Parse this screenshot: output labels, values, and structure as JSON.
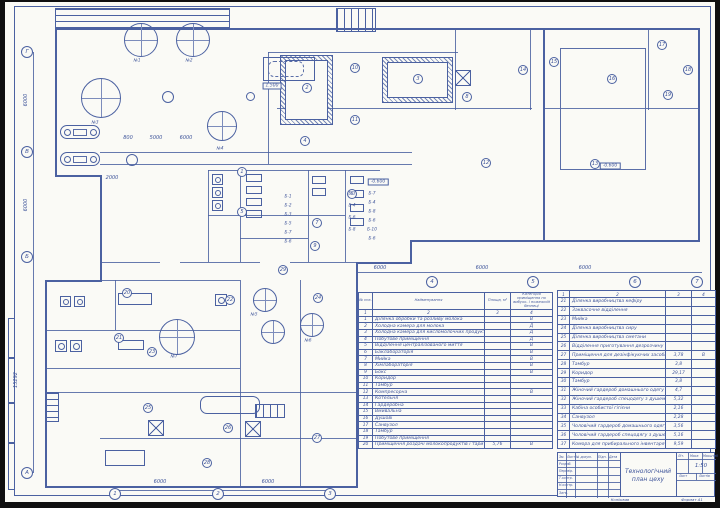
{
  "colors": {
    "line": "#4b61a1",
    "text": "#3e549a",
    "sheet": "#fafaf6",
    "background": "#121212"
  },
  "stamp": {
    "title_line1": "Технологічний",
    "title_line2": "план цеху",
    "scale_value": "1:50",
    "header_cols": [
      "Зм.",
      "Лист",
      "№ докум.",
      "Підп.",
      "Дата"
    ],
    "role_rows": [
      "Розроб.",
      "Перевір.",
      "Т.контр.",
      "Н.контр.",
      "Затв."
    ],
    "lit_label": "Літ.",
    "mass_label": "Маса",
    "scale_label": "Масштаб",
    "sheet_label": "Лист",
    "sheets_label": "Листів",
    "copied_label": "Копіював",
    "format_label": "Формат А1"
  },
  "room_table_1": {
    "headers": [
      "№ поз.",
      "Найменування",
      "Площа, м²",
      "Категорія приміщення по вибухо- і пожежній безпеці"
    ],
    "col_numbers": [
      "1",
      "2",
      "3",
      "4"
    ],
    "rows": [
      [
        "1",
        "Ділянка обробки та розливу молока",
        "",
        "В"
      ],
      [
        "2",
        "Холодна камера для молока",
        "",
        "Д"
      ],
      [
        "3",
        "Холодна камера для кисломолочних продуктів",
        "",
        "Д"
      ],
      [
        "4",
        "Побутове приміщення",
        "",
        "Д"
      ],
      [
        "5",
        "Відділення централізованого миття",
        "",
        "В"
      ],
      [
        "6",
        "Баклабораторія",
        "",
        "В"
      ],
      [
        "7",
        "Мийка",
        "",
        "В"
      ],
      [
        "8",
        "Хімлабораторія",
        "",
        "В"
      ],
      [
        "9",
        "Бокс",
        "",
        "В"
      ],
      [
        "10",
        "Коридор",
        "",
        ""
      ],
      [
        "11",
        "Тамбур",
        "",
        ""
      ],
      [
        "12",
        "Компресорна",
        "",
        "В"
      ],
      [
        "13",
        "Котельня",
        "",
        ""
      ],
      [
        "14",
        "Гардеробна",
        "",
        ""
      ],
      [
        "15",
        "Вмивальна",
        "",
        ""
      ],
      [
        "16",
        "Душові",
        "",
        ""
      ],
      [
        "17",
        "Санвузол",
        "",
        ""
      ],
      [
        "18",
        "Тамбур",
        "",
        ""
      ],
      [
        "19",
        "Побутове приміщення",
        "",
        ""
      ],
      [
        "20",
        "Приміщення роздачі молокопродуктів і тари",
        "5,76",
        "В"
      ]
    ]
  },
  "room_table_2": {
    "col_numbers": [
      "1",
      "2",
      "3",
      "4"
    ],
    "rows": [
      [
        "21",
        "Ділянка виробництва кефіру",
        "",
        ""
      ],
      [
        "22",
        "Заквасочне відділення",
        "",
        ""
      ],
      [
        "23",
        "Мийка",
        "",
        ""
      ],
      [
        "24",
        "Ділянка виробництва сиру",
        "",
        ""
      ],
      [
        "25",
        "Ділянка виробництва сметани",
        "",
        ""
      ],
      [
        "26",
        "Відділення приготування дезрозчину",
        "",
        ""
      ],
      [
        "27",
        "Приміщення для дезінфікуючих засобів",
        "3,78",
        "В"
      ],
      [
        "28",
        "Тамбур",
        "3,8",
        ""
      ],
      [
        "29",
        "Коридор",
        "29,17",
        ""
      ],
      [
        "30",
        "Тамбур",
        "3,8",
        ""
      ],
      [
        "31",
        "Жіночий гардероб домашнього одягу",
        "4,7",
        ""
      ],
      [
        "32",
        "Жіночий гардероб спецодягу з душем",
        "5,32",
        ""
      ],
      [
        "33",
        "Кабіна особистої гігієни",
        "2,16",
        ""
      ],
      [
        "34",
        "Санвузол",
        "2,28",
        ""
      ],
      [
        "35",
        "Чоловічий гардероб домашнього одягу",
        "3,56",
        ""
      ],
      [
        "36",
        "Чоловічий гардероб спецодягу з душем",
        "5,16",
        ""
      ],
      [
        "37",
        "Комора для прибирального інвентаря",
        "9,59",
        ""
      ]
    ]
  },
  "plan": {
    "room_markers": [
      {
        "n": "1",
        "x": 242,
        "y": 172
      },
      {
        "n": "2",
        "x": 307,
        "y": 88
      },
      {
        "n": "3",
        "x": 418,
        "y": 79
      },
      {
        "n": "4",
        "x": 305,
        "y": 141
      },
      {
        "n": "5",
        "x": 242,
        "y": 212
      },
      {
        "n": "6",
        "x": 352,
        "y": 194
      },
      {
        "n": "7",
        "x": 317,
        "y": 223
      },
      {
        "n": "8",
        "x": 467,
        "y": 97
      },
      {
        "n": "9",
        "x": 315,
        "y": 246
      },
      {
        "n": "10",
        "x": 355,
        "y": 68
      },
      {
        "n": "11",
        "x": 355,
        "y": 120
      },
      {
        "n": "12",
        "x": 486,
        "y": 163
      },
      {
        "n": "13",
        "x": 595,
        "y": 164
      },
      {
        "n": "14",
        "x": 523,
        "y": 70
      },
      {
        "n": "15",
        "x": 554,
        "y": 62
      },
      {
        "n": "16",
        "x": 612,
        "y": 79
      },
      {
        "n": "17",
        "x": 662,
        "y": 45
      },
      {
        "n": "18",
        "x": 688,
        "y": 70
      },
      {
        "n": "19",
        "x": 668,
        "y": 95
      },
      {
        "n": "20",
        "x": 127,
        "y": 293
      },
      {
        "n": "21",
        "x": 119,
        "y": 338
      },
      {
        "n": "22",
        "x": 230,
        "y": 300
      },
      {
        "n": "23",
        "x": 152,
        "y": 352
      },
      {
        "n": "24",
        "x": 318,
        "y": 298
      },
      {
        "n": "25",
        "x": 148,
        "y": 408
      },
      {
        "n": "26",
        "x": 228,
        "y": 428
      },
      {
        "n": "27",
        "x": 317,
        "y": 438
      },
      {
        "n": "28",
        "x": 207,
        "y": 463
      },
      {
        "n": "29",
        "x": 283,
        "y": 270
      }
    ],
    "grid_markers": [
      {
        "n": "1",
        "x": 115,
        "y": 494
      },
      {
        "n": "2",
        "x": 218,
        "y": 494
      },
      {
        "n": "3",
        "x": 330,
        "y": 494
      },
      {
        "n": "4",
        "x": 432,
        "y": 282
      },
      {
        "n": "5",
        "x": 533,
        "y": 282
      },
      {
        "n": "6",
        "x": 635,
        "y": 282
      },
      {
        "n": "7",
        "x": 697,
        "y": 282
      },
      {
        "n": "А",
        "x": 27,
        "y": 473
      },
      {
        "n": "Б",
        "x": 27,
        "y": 257
      },
      {
        "n": "В",
        "x": 27,
        "y": 152
      },
      {
        "n": "Г",
        "x": 27,
        "y": 52
      }
    ],
    "dim_labels": [
      {
        "t": "6000",
        "x": 380,
        "y": 268,
        "r": 0
      },
      {
        "t": "6000",
        "x": 482,
        "y": 268,
        "r": 0
      },
      {
        "t": "6000",
        "x": 585,
        "y": 268,
        "r": 0
      },
      {
        "t": "6000",
        "x": 160,
        "y": 482,
        "r": 0
      },
      {
        "t": "6000",
        "x": 268,
        "y": 482,
        "r": 0
      },
      {
        "t": "800",
        "x": 128,
        "y": 138,
        "r": 0
      },
      {
        "t": "5000",
        "x": 156,
        "y": 138,
        "r": 0
      },
      {
        "t": "6000",
        "x": 186,
        "y": 138,
        "r": 0
      },
      {
        "t": "2000",
        "x": 112,
        "y": 178,
        "r": 0
      },
      {
        "t": "6000",
        "x": 26,
        "y": 100,
        "r": 1
      },
      {
        "t": "6000",
        "x": 26,
        "y": 205,
        "r": 1
      },
      {
        "t": "15292",
        "x": 16,
        "y": 380,
        "r": 1
      }
    ],
    "elevation_marks": [
      {
        "t": "-0.600",
        "x": 378,
        "y": 182
      },
      {
        "t": "-0.600",
        "x": 610,
        "y": 166
      },
      {
        "t": "1.500",
        "x": 272,
        "y": 86
      }
    ],
    "equipment_labels": [
      {
        "t": "Б-1",
        "x": 288,
        "y": 196
      },
      {
        "t": "Б-2",
        "x": 288,
        "y": 205
      },
      {
        "t": "Б-3",
        "x": 288,
        "y": 214
      },
      {
        "t": "Б-5",
        "x": 288,
        "y": 223
      },
      {
        "t": "Б-7",
        "x": 288,
        "y": 232
      },
      {
        "t": "Б-6",
        "x": 288,
        "y": 241
      },
      {
        "t": "Б-3",
        "x": 352,
        "y": 193
      },
      {
        "t": "Б-4",
        "x": 352,
        "y": 205
      },
      {
        "t": "Б-6",
        "x": 352,
        "y": 217
      },
      {
        "t": "Б-8",
        "x": 352,
        "y": 229
      },
      {
        "t": "Б-7",
        "x": 372,
        "y": 193
      },
      {
        "t": "Б-4",
        "x": 372,
        "y": 202
      },
      {
        "t": "Б-8",
        "x": 372,
        "y": 211
      },
      {
        "t": "Б-6",
        "x": 372,
        "y": 220
      },
      {
        "t": "Б-10",
        "x": 372,
        "y": 229
      },
      {
        "t": "Б-6",
        "x": 372,
        "y": 238
      },
      {
        "t": "№1",
        "x": 137,
        "y": 60
      },
      {
        "t": "№2",
        "x": 189,
        "y": 60
      },
      {
        "t": "№3",
        "x": 95,
        "y": 122
      },
      {
        "t": "№4",
        "x": 220,
        "y": 148
      },
      {
        "t": "№5",
        "x": 254,
        "y": 314
      },
      {
        "t": "№6",
        "x": 308,
        "y": 340
      },
      {
        "t": "№7",
        "x": 174,
        "y": 356
      }
    ]
  }
}
